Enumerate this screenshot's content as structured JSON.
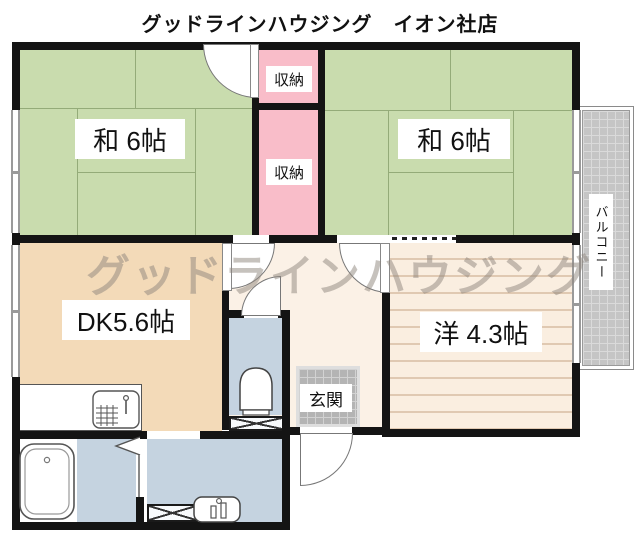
{
  "title": "グッドラインハウジング　イオン社店",
  "watermark": "グッドラインハウジング",
  "rooms": {
    "tatami_left": "和 6帖",
    "tatami_right": "和 6帖",
    "dk": "DK5.6帖",
    "western": "洋 4.3帖",
    "storage_upper": "収納",
    "storage_lower": "収納",
    "entrance": "玄関",
    "balcony": "バルコニー"
  },
  "icons": {
    "bathtub": "bathtub-icon",
    "toilet": "toilet-icon",
    "washbasin": "washbasin-icon",
    "kitchen_sink": "kitchen-sink-icon",
    "folding_door": "folding-door-icon",
    "washer_pan": "washer-pan-x-icon",
    "storage_nook": "x-box-icon"
  },
  "colors": {
    "wall": "#141414",
    "tatami": "#c9dcae",
    "tatami_line": "#94ab79",
    "storage": "#f9bdc9",
    "dk": "#f3dab8",
    "hall": "#fbf1e6",
    "western": "#faeee0",
    "western_line": "#e0c9b2",
    "wet": "#c5d3e0",
    "tile_entry": "#b4b4b4",
    "tile_balcony": "#c5c5c5",
    "watermark": "#8f867e"
  }
}
